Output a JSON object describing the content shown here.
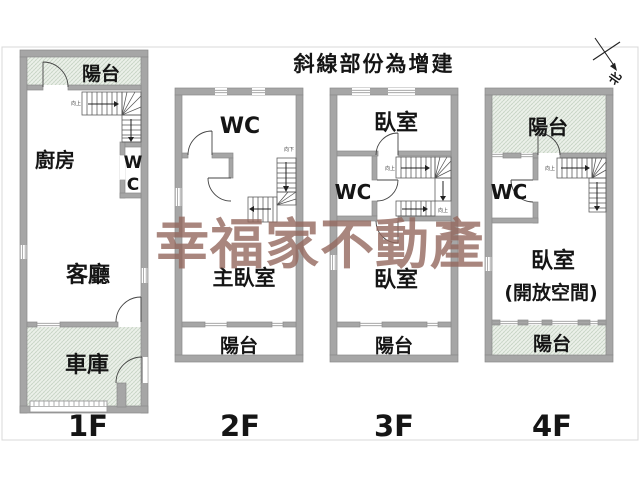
{
  "legend_title": "斜線部份為增建",
  "compass_label": "北",
  "watermark": "幸福家不動產",
  "colors": {
    "wall": "#a6a6a6",
    "hatch_background": "#eef2ec",
    "hatch_line": "#c6d3c4",
    "watermark": "#94685e",
    "label_text": "#151515"
  },
  "floor1": {
    "balcony": "陽台",
    "kitchen": "廚房",
    "wc_line1": "W",
    "wc_line2": "C",
    "living_room": "客廳",
    "garage": "車庫",
    "stair_note": "向上",
    "label": "1F"
  },
  "floor2": {
    "wc": "WC",
    "master_bedroom": "主臥室",
    "balcony": "陽台",
    "stair_note": "向下",
    "label": "2F"
  },
  "floor3": {
    "bedroom_top": "臥室",
    "wc": "WC",
    "bedroom_bottom": "臥室",
    "balcony": "陽台",
    "stair_note_upper": "向上",
    "stair_note_lower": "向上",
    "label": "3F"
  },
  "floor4": {
    "balcony_top": "陽台",
    "wc": "WC",
    "bedroom": "臥室",
    "bedroom_note": "(開放空間)",
    "balcony_bottom": "陽台",
    "stair_note": "向上",
    "label": "4F"
  }
}
